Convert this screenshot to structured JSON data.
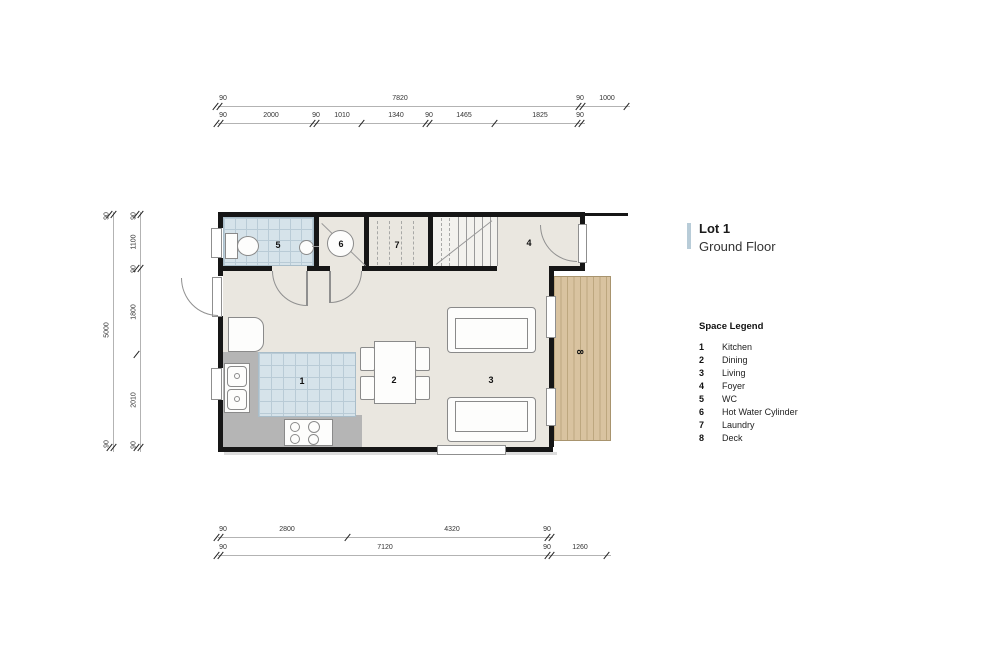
{
  "title": {
    "lot": "Lot 1",
    "floor": "Ground Floor"
  },
  "legend": {
    "heading": "Space Legend",
    "items": [
      {
        "num": "1",
        "label": "Kitchen"
      },
      {
        "num": "2",
        "label": "Dining"
      },
      {
        "num": "3",
        "label": "Living"
      },
      {
        "num": "4",
        "label": "Foyer"
      },
      {
        "num": "5",
        "label": "WC"
      },
      {
        "num": "6",
        "label": "Hot Water Cylinder"
      },
      {
        "num": "7",
        "label": "Laundry"
      },
      {
        "num": "8",
        "label": "Deck"
      }
    ]
  },
  "rooms": {
    "kitchen": "1",
    "dining": "2",
    "living": "3",
    "foyer": "4",
    "wc": "5",
    "hwc": "6",
    "laundry": "7",
    "deck": "8"
  },
  "dimensions": {
    "top_overall": [
      "90",
      "7820",
      "90",
      "1000"
    ],
    "top_detail": [
      "90",
      "2000",
      "90",
      "1010",
      "1340",
      "90",
      "1465",
      "1825",
      "90"
    ],
    "left_overall": [
      "90",
      "5000",
      "90"
    ],
    "left_detail": [
      "90",
      "1100",
      "90",
      "1800",
      "2010",
      "90"
    ],
    "bottom_detail": [
      "90",
      "2800",
      "4320",
      "90"
    ],
    "bottom_overall": [
      "90",
      "7120",
      "90",
      "1260"
    ]
  },
  "colors": {
    "wall": "#161616",
    "interior_floor": "#eae7e0",
    "tile": "#d6e3ea",
    "deck": "#d9c3a0",
    "counter": "#b5b5b5",
    "title_accent": "#b8ccd8"
  }
}
